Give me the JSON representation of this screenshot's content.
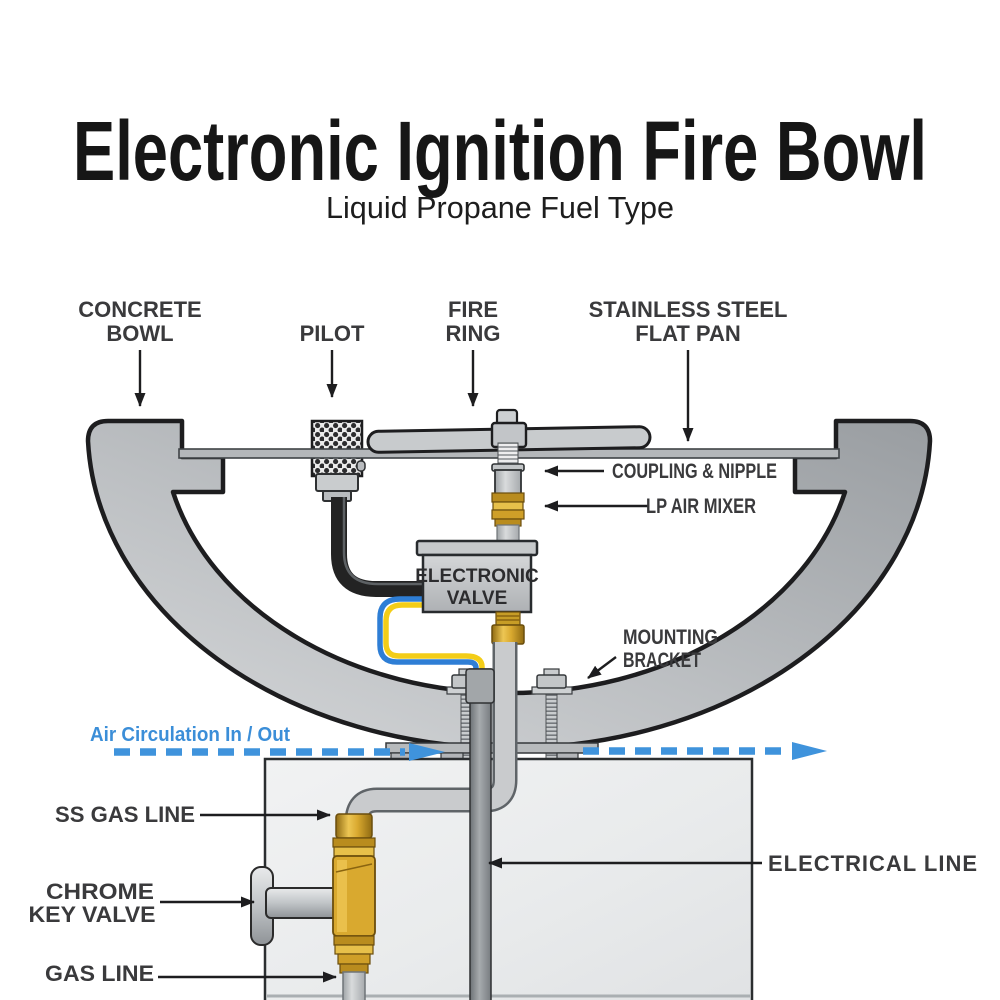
{
  "title": "Electronic Ignition Fire Bowl",
  "subtitle": "Liquid Propane Fuel Type",
  "labels": {
    "concrete_bowl": {
      "line1": "CONCRETE",
      "line2": "BOWL"
    },
    "pilot": "PILOT",
    "fire_ring": {
      "line1": "FIRE",
      "line2": "RING"
    },
    "flat_pan": {
      "line1": "STAINLESS STEEL",
      "line2": "FLAT PAN"
    },
    "coupling": "COUPLING & NIPPLE",
    "lp_air_mixer": "LP AIR MIXER",
    "electronic_valve": {
      "line1": "ELECTRONIC",
      "line2": "VALVE"
    },
    "mounting_bracket": {
      "line1": "MOUNTING",
      "line2": "BRACKET"
    },
    "air_circulation": "Air Circulation In / Out",
    "ss_gas_line": "SS GAS LINE",
    "chrome_key_valve": {
      "line1": "CHROME",
      "line2": "KEY VALVE"
    },
    "gas_line": "GAS LINE",
    "electrical_line": "ELECTRICAL LINE"
  },
  "colors": {
    "label_text": "#3a3a3c",
    "outline": "#1d1d1f",
    "bowl_light": "#d3d5d7",
    "bowl_dark": "#9b9fa3",
    "pan_gray": "#b4b7ba",
    "brass": "#d9a92f",
    "brass_dark": "#8f6a12",
    "wire_blue": "#2e7ed5",
    "wire_yellow": "#f3cd18",
    "circulation_blue": "#3b8ed8",
    "pipe_gray": "#c9cbcd",
    "conduit_gray": "#858a8e",
    "pedestal_gray": "#eceeef",
    "title_black": "#161616"
  }
}
